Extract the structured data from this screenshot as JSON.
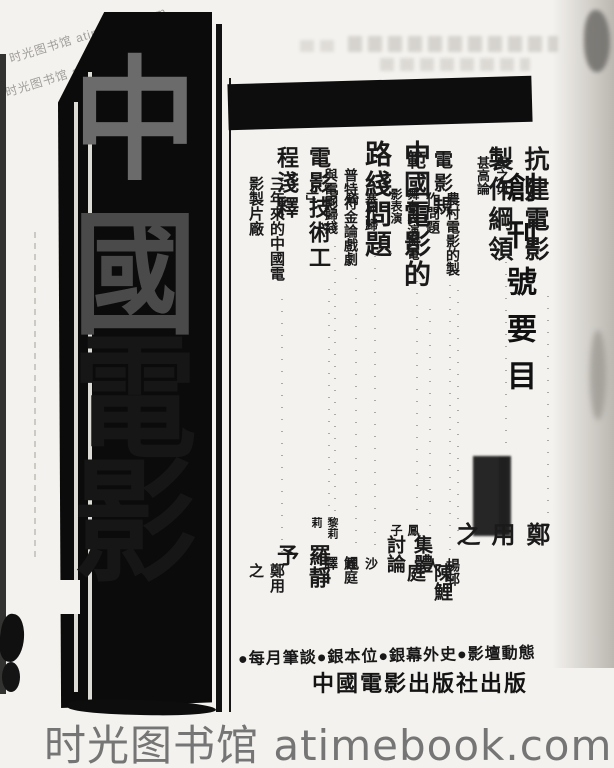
{
  "colors": {
    "paper": "#f4f2ee",
    "ink": "#0b0b0b",
    "watermark_gray": "#757575"
  },
  "watermarks": {
    "diagonal_text": "时光图书馆 atimebook.com",
    "bottom_text": "时光图书馆 atimebook.com"
  },
  "masthead": {
    "title": "中國電影",
    "title_chars": [
      "中",
      "國",
      "電",
      "影"
    ]
  },
  "toc": {
    "header": "創刊號要目",
    "entries": [
      {
        "title": "卑之毋甚高論",
        "leader": "································",
        "author": "█████"
      },
      {
        "title": "抗建電影製作綱領",
        "leader": "································",
        "author": "鄭用之"
      },
      {
        "title": "農村電影的製作問題",
        "leader": "································",
        "author": "楊邨人"
      },
      {
        "title": "電影規範",
        "leader": "································",
        "author": "陳鯉庭"
      },
      {
        "title": "舞台表演與電影表演",
        "leader": "································",
        "author": "鳳子"
      },
      {
        "title": "中國電影的路綫問題",
        "leader": "································",
        "author": "集體討論"
      },
      {
        "title": "塞外歸騎",
        "leader": "································",
        "author": "沙風"
      },
      {
        "title": "普特符金論戲劇與電影",
        "leader": "································",
        "author": "鯉庭譯"
      },
      {
        "title": "「囘歸綫上」",
        "leader": "································",
        "author": "黎莉莉"
      },
      {
        "title": "電影技術工程淺釋",
        "leader": "································",
        "author": "羅靜予"
      },
      {
        "title": "三年來的中國電影製片廠",
        "leader": "································",
        "author": "鄭用之"
      }
    ]
  },
  "footer": {
    "features_line": "●每月筆談●銀本位●銀幕外史●影壇動態",
    "publisher": "中國電影出版社出版"
  }
}
